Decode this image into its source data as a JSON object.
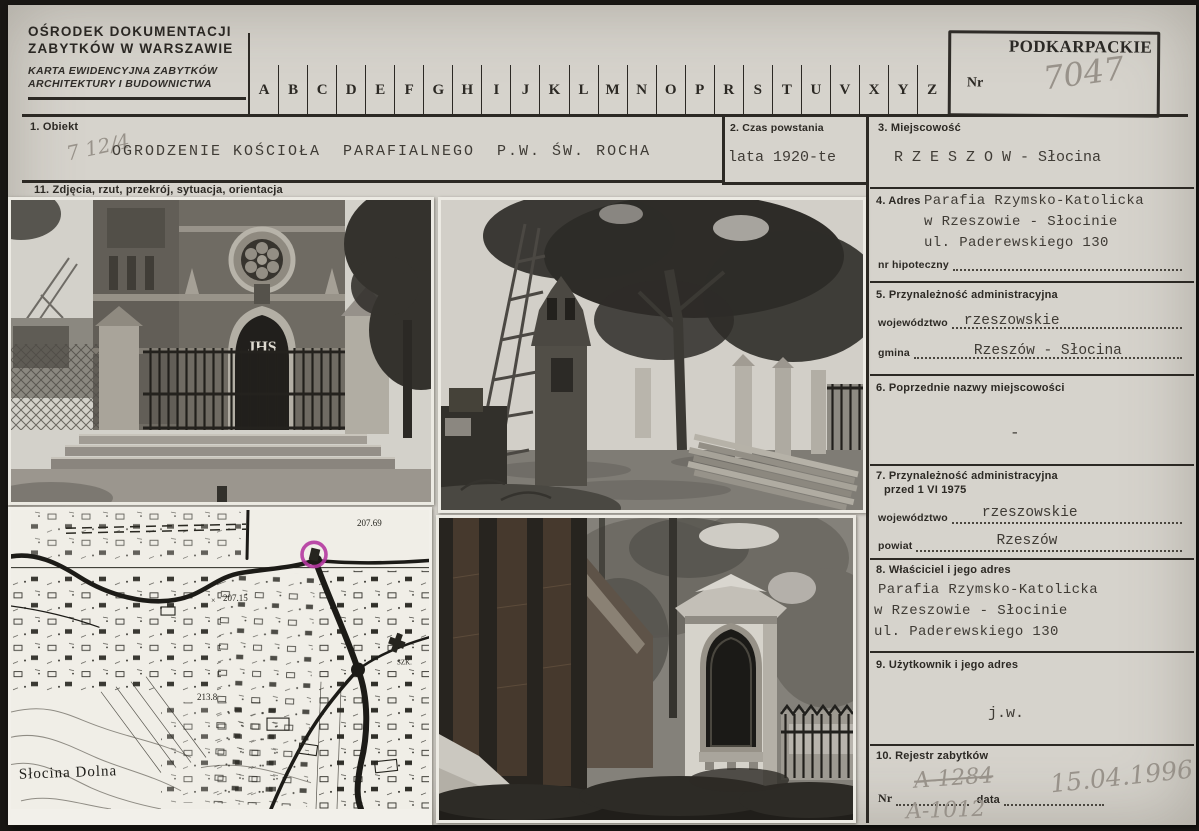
{
  "colors": {
    "card_bg": "#d6d3cc",
    "scan_frame": "#191714",
    "ink": "#2c2924",
    "typewriter": "#3f3b35",
    "pencil": "#98928a",
    "map_highlight": "#b437a0"
  },
  "header": {
    "org_line1": "OŚRODEK DOKUMENTACJI",
    "org_line2": "ZABYTKÓW W WARSZAWIE",
    "card_type_line1": "KARTA EWIDENCYJNA ZABYTKÓW",
    "card_type_line2": "ARCHITEKTURY I BUDOWNICTWA",
    "alphabet": [
      "A",
      "B",
      "C",
      "D",
      "E",
      "F",
      "G",
      "H",
      "I",
      "J",
      "K",
      "L",
      "M",
      "N",
      "O",
      "P",
      "R",
      "S",
      "T",
      "U",
      "V",
      "X",
      "Y",
      "Z"
    ],
    "stamp_text": "PODKARPACKIE",
    "nr_label": "Nr",
    "nr_value": "7047"
  },
  "fields": {
    "f1": {
      "label": "1. Obiekt",
      "pencil_note": "7 12/4",
      "value": "OGRODZENIE KOŚCIOŁA  PARAFIALNEGO  P.W. ŚW. ROCHA"
    },
    "f2": {
      "label": "2. Czas powstania",
      "value": "lata 1920-te"
    },
    "f3": {
      "label": "3. Miejscowość",
      "value": "R Z E S Z O W - Słocina"
    },
    "f4": {
      "label": "4. Adres",
      "line1": "Parafia Rzymsko-Katolicka",
      "line2": "w Rzeszowie - Słocinie",
      "line3": "ul. Paderewskiego 130",
      "sub_label": "nr hipoteczny"
    },
    "f5": {
      "label": "5. Przynależność administracyjna",
      "row1_label": "województwo",
      "row1_value": "rzeszowskie",
      "row2_label": "gmina",
      "row2_value": "Rzeszów - Słocina"
    },
    "f6": {
      "label": "6. Poprzednie nazwy miejscowości",
      "value": "-"
    },
    "f7": {
      "label_line1": "7. Przynależność administracyjna",
      "label_line2": "przed 1 VI 1975",
      "row1_label": "województwo",
      "row1_value": "rzeszowskie",
      "row2_label": "powiat",
      "row2_value": "Rzeszów"
    },
    "f8": {
      "label": "8. Właściciel i jego adres",
      "line1": "Parafia Rzymsko-Katolicka",
      "line2": "w Rzeszowie - Słocinie",
      "line3": "ul. Paderewskiego 130"
    },
    "f9": {
      "label": "9. Użytkownik i jego adres",
      "value": "j.w."
    },
    "f10": {
      "label": "10. Rejestr zabytków",
      "nr_label": "Nr",
      "nr_old": "A-1284",
      "nr_new": "A-1012",
      "data_label": "data",
      "data_value": "15.04.1996"
    },
    "f11": {
      "label": "11. Zdjęcia, rzut, przekrój, sytuacja, orientacja"
    }
  },
  "photos": {
    "church_inscription": "JHS"
  },
  "map_labels": {
    "elev_1": "207.69",
    "elev_2": "207.15",
    "elev_3": "213.8",
    "place": "Słocina Dolna",
    "school": "SZK."
  }
}
